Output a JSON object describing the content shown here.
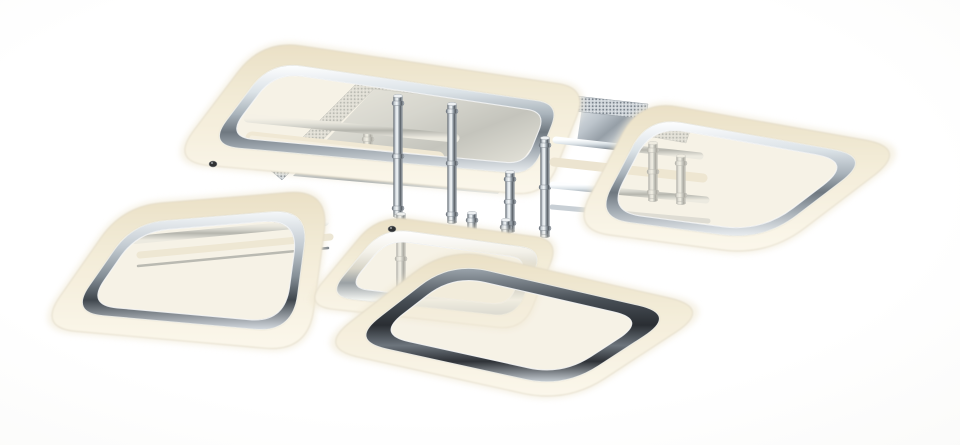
{
  "meta": {
    "type": "product-photo",
    "alt": "Modern flush-mount LED ceiling chandelier with five interlocking rounded-square chrome frames, each surrounded by a warm white acrylic diffuser band, suspended from a polished chrome canopy with knurled edging and cylindrical chrome posts, photographed on a plain white background"
  },
  "product": {
    "subject": "LED ceiling chandelier",
    "frame_shape": "rounded squares",
    "rings_visible": 5,
    "finish": "polished chrome",
    "diffuser": "warm white acrylic",
    "mount": "square chrome canopy with perforated edge",
    "background": "seamless white"
  },
  "palette": {
    "background": "#ffffff",
    "diffuser_cream": "#f2e9d4",
    "diffuser_deep": "#e8dec3",
    "diffuser_glow": "#fbf8ee",
    "chrome_light": "#f2f5f7",
    "chrome_mid": "#a9b2ba",
    "chrome_dark": "#4d545b",
    "chrome_deep": "#26292e",
    "mirror_blue": "#8f9aa4"
  }
}
